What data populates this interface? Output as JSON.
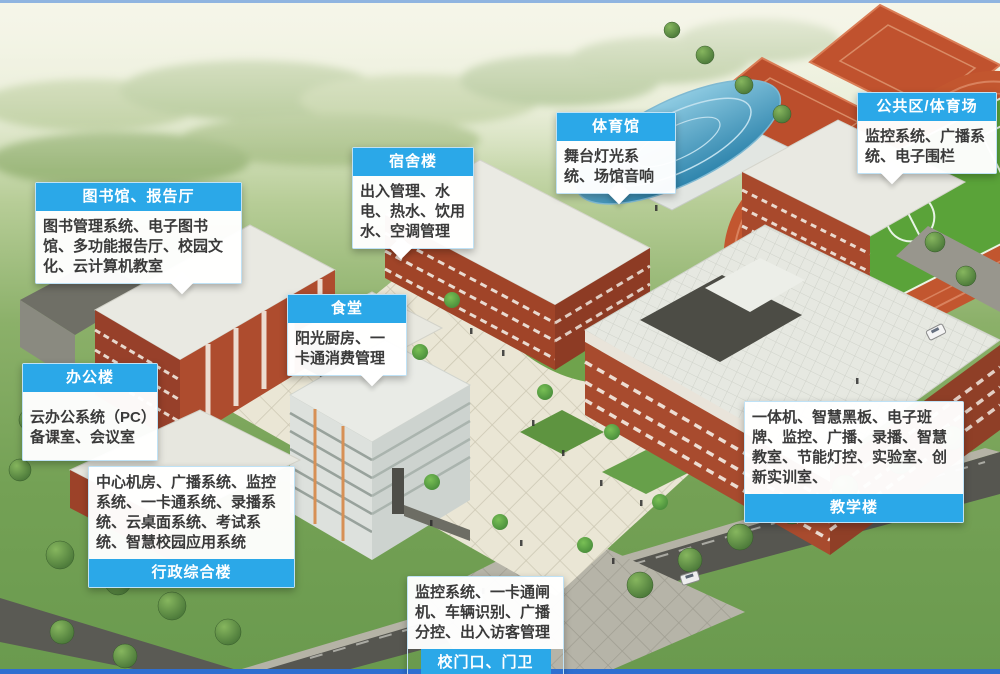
{
  "colors": {
    "label_header_bg": "#2BA8E8",
    "label_header_text": "#ffffff",
    "label_body_bg": "#ffffff",
    "label_body_text": "#3a3a3a",
    "top_edge_line": "#8fb4e0",
    "bottom_edge_line": "#2f6fd0",
    "track_red": "#c2562f",
    "field_green": "#5aa339",
    "brick_red": "#a84b2e",
    "dome_blue": "#4fa0c4"
  },
  "callouts": [
    {
      "id": "library",
      "title": "图书馆、报告厅",
      "body": "图书管理系统、电子图书馆、多功能报告厅、校园文化、云计算机教室",
      "header_position": "top"
    },
    {
      "id": "dormitory",
      "title": "宿舍楼",
      "body": "出入管理、水电、热水、饮用水、空调管理",
      "header_position": "top"
    },
    {
      "id": "gymnasium",
      "title": "体育馆",
      "body": "舞台灯光系统、场馆音响",
      "header_position": "top"
    },
    {
      "id": "public-area",
      "title": "公共区/体育场",
      "body": "监控系统、广播系统、电子围栏",
      "header_position": "top"
    },
    {
      "id": "canteen",
      "title": "食堂",
      "body": "阳光厨房、一卡通消费管理",
      "header_position": "top"
    },
    {
      "id": "office",
      "title": "办公楼",
      "body": "云办公系统（PC）备课室、会议室",
      "header_position": "top"
    },
    {
      "id": "admin-complex",
      "title": "行政综合楼",
      "body": "中心机房、广播系统、监控系统、一卡通系统、录播系统、云桌面系统、考试系统、智慧校园应用系统",
      "header_position": "bottom"
    },
    {
      "id": "teaching",
      "title": "教学楼",
      "body": "一体机、智慧黑板、电子班牌、监控、广播、录播、智慧教室、节能灯控、实验室、创新实训室、",
      "header_position": "bottom"
    },
    {
      "id": "gate",
      "title": "校门口、门卫",
      "body": "监控系统、一卡通闸机、车辆识别、广播分控、出入访客管理",
      "header_position": "bottom"
    }
  ]
}
